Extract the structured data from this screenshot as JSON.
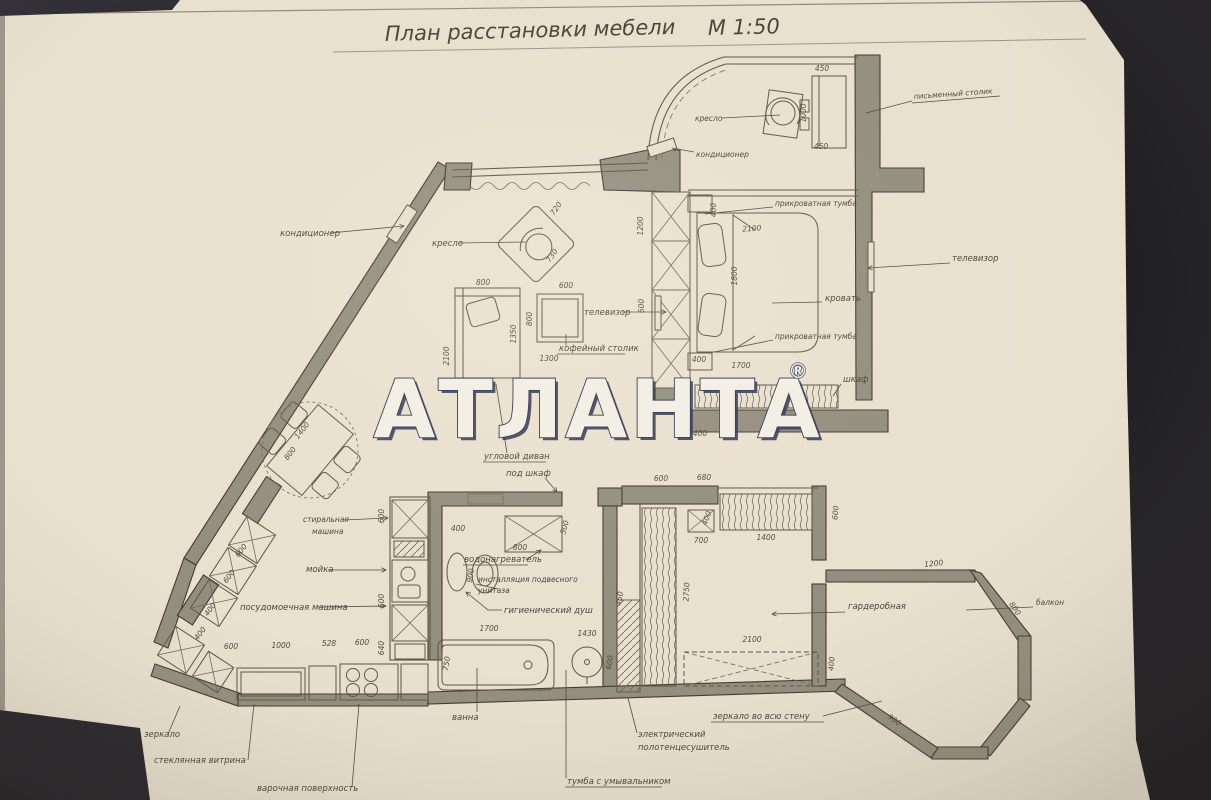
{
  "title": {
    "label": "План расстановки мебели",
    "scale": "М 1:50"
  },
  "watermark": {
    "text": "АТЛАНТА",
    "registered": "®"
  },
  "labels": {
    "balcony_armchair": "кресло",
    "balcony_desk": "письменный столик",
    "balcony_ac": "кондиционер",
    "bedroom_nightstand_top": "прикроватная тумба",
    "bedroom_bed": "кровать",
    "bedroom_nightstand_bottom": "прикроватная тумба",
    "bedroom_tv": "телевизор",
    "bedroom_closet": "шкаф",
    "living_ac": "кондиционер",
    "living_armchair": "кресло",
    "living_tv": "телевизор",
    "living_coffee_table": "кофейный столик",
    "living_sofa": "угловой диван",
    "hall_closet": "под шкаф",
    "kitchen_washing_1": "стиральная",
    "kitchen_washing_2": "машина",
    "kitchen_sink": "мойка",
    "kitchen_dishwasher": "посудомоечная машина",
    "bath_heater": "водонагреватель",
    "bath_toilet_1": "инсталляция подвесного",
    "bath_toilet_2": "унитаза",
    "bath_shower": "гигиенический душ",
    "bath_tub": "ванна",
    "bath_vanity": "тумба с умывальником",
    "bath_towel_1": "электрический",
    "bath_towel_2": "полотенцесушитель",
    "mirror_full_wall": "зеркало во всю стену",
    "wardrobe_room": "гардеробная",
    "bay_balcony": "балкон",
    "entry_mirror": "зеркало",
    "kitchen_vitrine": "стеклянная витрина",
    "kitchen_cooktop": "варочная поверхность"
  },
  "dimensions": {
    "desk_top": "450",
    "desk_bottom": "450",
    "desk_side": "1000",
    "bed_w": "2100",
    "bed_l": "1800",
    "nightstand_top": "400",
    "nightstand_bottom": "400",
    "bed_bottom": "1700",
    "partition_upper": "1200",
    "partition_lower": "600",
    "armchair_w": "720",
    "armchair_h": "730",
    "sofa_w": "800",
    "sofa_l": "2100",
    "sofa_inner": "1350",
    "sofa_gap": "1300",
    "coffee_w": "600",
    "coffee_l": "800",
    "table_l": "1400",
    "table_w": "800",
    "kcab1": "600",
    "kcab2": "600",
    "kcab3": "400",
    "kcab4": "400",
    "krow1": "600",
    "krow2": "1000",
    "krow3": "528",
    "krow4": "600",
    "kcol1": "600",
    "kcol2": "600",
    "kcol3": "640",
    "hall": "400",
    "bath_niche": "400",
    "heater_w": "800",
    "heater_h": "500",
    "toilet": "900",
    "bath_right": "450",
    "tub_l": "1700",
    "tub_w": "750",
    "bath_floor": "1430",
    "basin": "600",
    "ward_top1": "600",
    "ward_top2": "680",
    "ward_shelf1": "400",
    "ward_shelf2": "700",
    "ward_rail": "1400",
    "ward_right": "600",
    "ward_depth": "2750",
    "ward_bottom": "2100",
    "ward_br": "400",
    "bay_top": "1200",
    "bay_right": "800",
    "bay_left": "900"
  }
}
